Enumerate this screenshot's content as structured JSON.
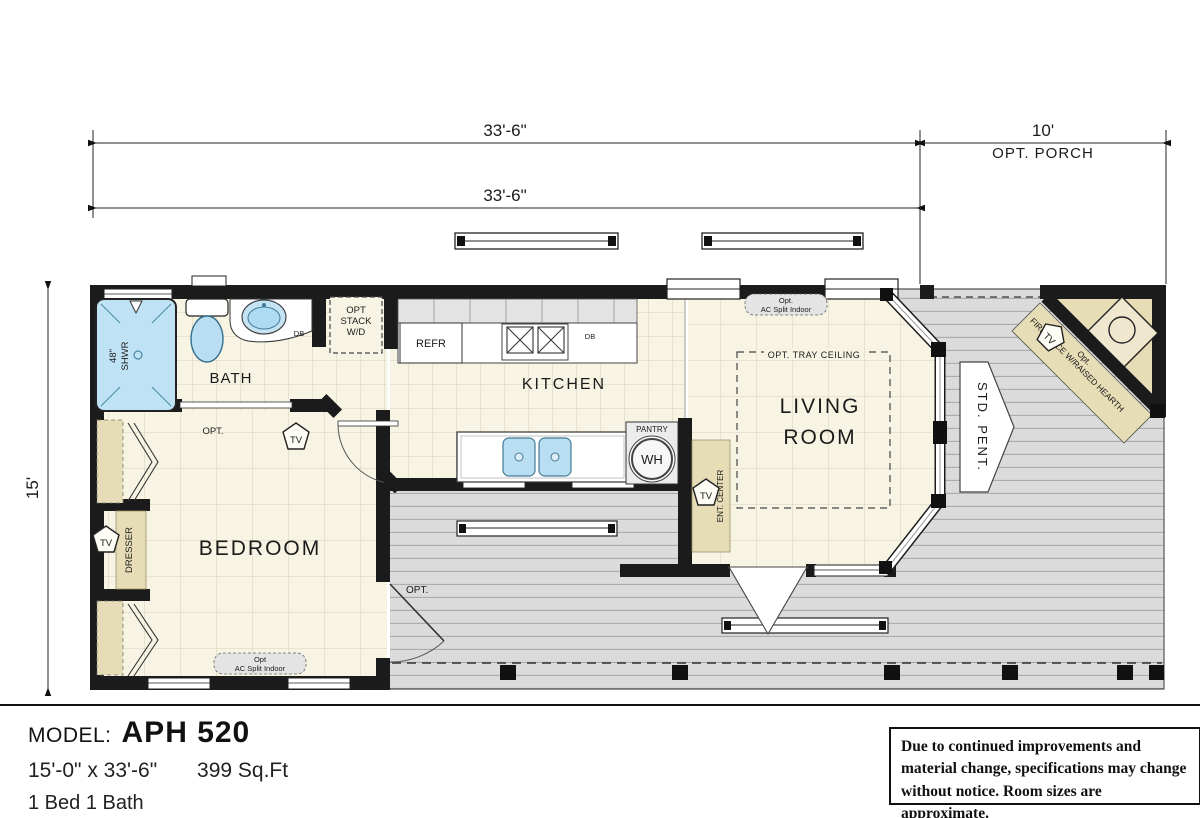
{
  "dimensions": {
    "width_top": "33'-6\"",
    "width_inner": "33'-6\"",
    "porch_width": "10'",
    "porch_label": "OPT. PORCH",
    "height_left": "15'"
  },
  "rooms": {
    "bath": "BATH",
    "kitchen": "KITCHEN",
    "living_line1": "LIVING",
    "living_line2": "ROOM",
    "bedroom": "BEDROOM"
  },
  "fixtures": {
    "shower_line1": "48\"",
    "shower_line2": "SHWR",
    "db_bath": "DB",
    "opt_stack_1": "OPT",
    "opt_stack_2": "STACK",
    "opt_stack_3": "W/D",
    "refr": "REFR",
    "db_kitchen": "DB",
    "pantry": "PANTRY",
    "wh": "WH",
    "ent_center": "ENT. CENTER",
    "tray_ceiling": "OPT. TRAY CEILING",
    "ac_split_top_1": "Opt.",
    "ac_split_top_2": "AC Split Indoor",
    "ac_split_bottom_1": "Opt",
    "ac_split_bottom_2": "AC Split Indoor",
    "opt_bath_door": "OPT.",
    "opt_deck_door": "OPT.",
    "tv": "TV",
    "std_pent": "STD. PENT.",
    "fireplace_1": "Opt.",
    "fireplace_2": "FIREPLACE W/RAISED HEARTH",
    "dresser": "DRESSER"
  },
  "footer": {
    "model_label": "MODEL:",
    "model_name": "APH 520",
    "size": "15'-0\" x 33'-6\"",
    "sqft": "399 Sq.Ft",
    "beds": "1 Bed 1 Bath"
  },
  "disclaimer": "Due to continued improvements and material change, specifications may change without notice. Room sizes are approximate.",
  "colors": {
    "wall": "#1b1b1b",
    "floor": "#f8f4e4",
    "deck": "#dbdbdb",
    "tan": "#e6dcb6",
    "fixture_blue": "#b9def1"
  }
}
